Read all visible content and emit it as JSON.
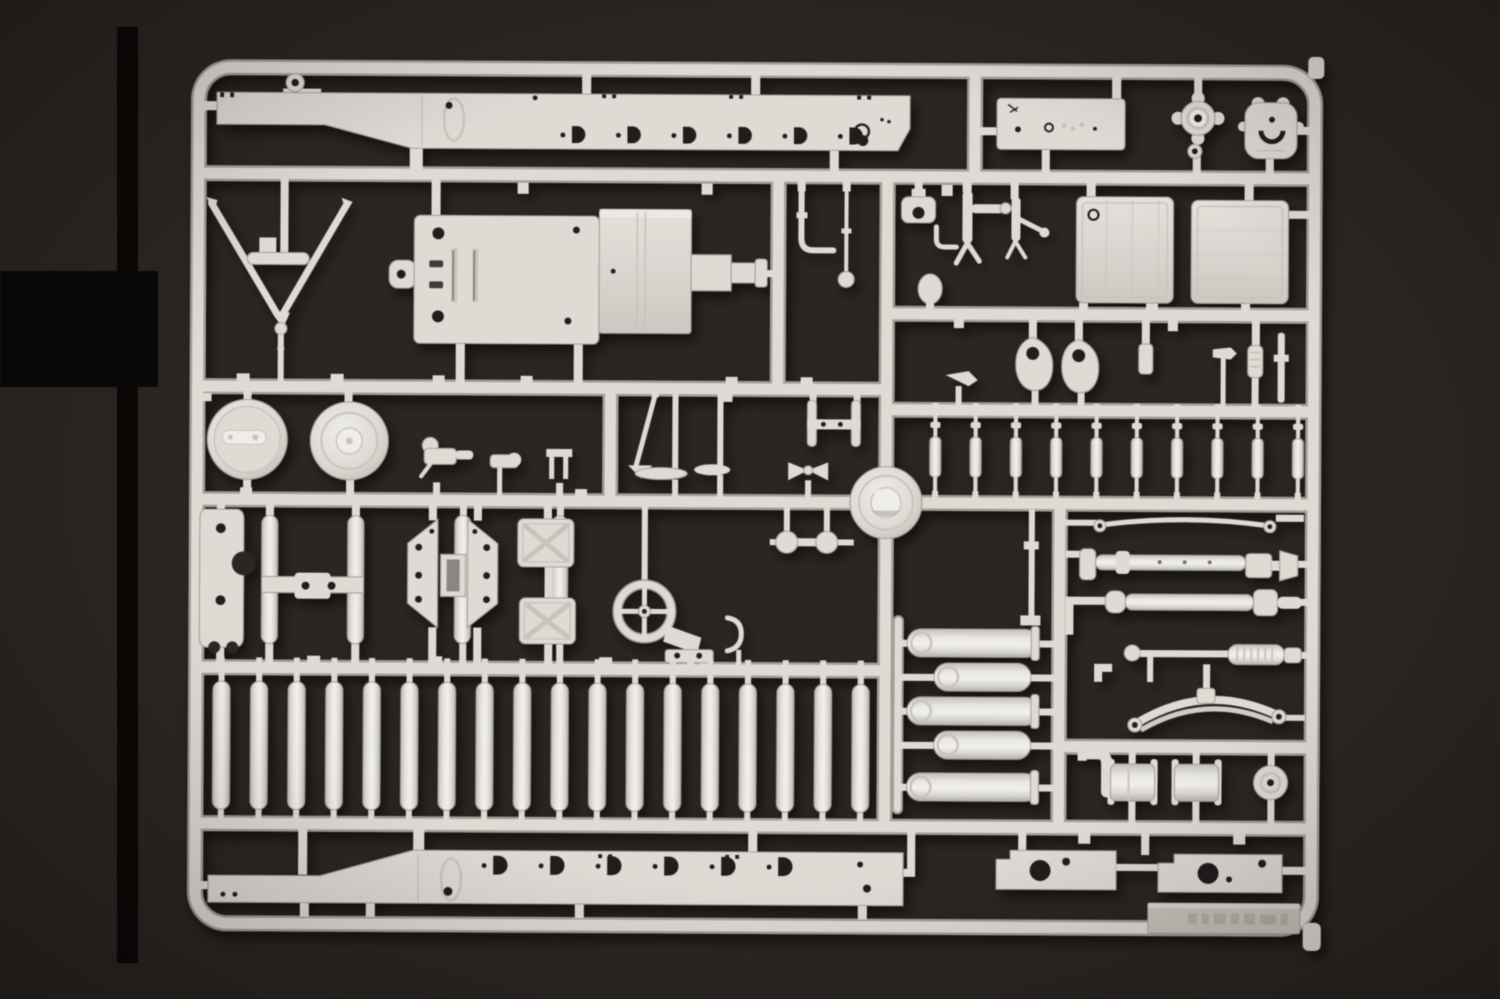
{
  "scene": {
    "type": "product photograph",
    "description": "Overhead product photo of an injection-moulded light grey polystyrene model-kit sprue (parts runner) for a military truck / artillery tractor kit, lying on a dark brown-black background. Black printing crop bars run along the left edge. The frame holds two long chassis side rails with stamped D-shaped slots, a V-shaped tow bar, an engine mounting plate with gearbox block, two round road wheels, rows of cylindrical rollers and bolts, two square fuel-tank panels, stacked exhaust cylinders, drive shafts, a curved leaf spring and many small fittings. An embossed maker tag in the lower right corner is not legible.",
    "background_color": "#2b2622",
    "crop_bar_color": "#0a0807",
    "plastic_color": "#dedbd5",
    "plastic_light_color": "#efede9",
    "plastic_dim_color": "#c8c4bd",
    "runner_edge_color": "#a39e97",
    "hole_color": "#241f1b"
  },
  "sprue": {
    "material": "light grey styrene",
    "maker_tag_text": "",
    "counts": {
      "road_rollers": 18,
      "track_bolts": 10,
      "top_rail_slots": 6,
      "bottom_rail_slots": 6,
      "muffler_cylinders": 5,
      "fuel_tanks": 2,
      "road_wheels": 2,
      "chassis_rails": 2,
      "square_cross_pads": 2,
      "teardrop_covers": 2,
      "bottom_plates": 2
    },
    "notable_parts": [
      {
        "id": "chassis-rail-top",
        "label": "Chassis side rail with D-slots (upper)"
      },
      {
        "id": "tow-bar",
        "label": "V-shaped tow bar with hitch ring"
      },
      {
        "id": "engine-plate",
        "label": "Engine mounting plate"
      },
      {
        "id": "gearbox-block",
        "label": "Gearbox block with muzzle shaft"
      },
      {
        "id": "road-wheel-strap",
        "label": "Road wheel with axle strap"
      },
      {
        "id": "road-wheel-ribbed",
        "label": "Road wheel with concentric ribs"
      },
      {
        "id": "fuel-tank-a",
        "label": "Square fuel tank panel with filler ring"
      },
      {
        "id": "fuel-tank-b",
        "label": "Square fuel tank panel, lined"
      },
      {
        "id": "central-hub",
        "label": "Central domed wheel hub"
      },
      {
        "id": "sight-wheel",
        "label": "Hand wheel with cross spokes"
      },
      {
        "id": "bogie-plates",
        "label": "Suspension bogie side plates"
      },
      {
        "id": "leaf-spring",
        "label": "Curved leaf spring with eyes"
      },
      {
        "id": "roller-row",
        "label": "Row of cylindrical road rollers"
      },
      {
        "id": "bolt-row",
        "label": "Row of suspension bolt pins"
      },
      {
        "id": "muffler-stack",
        "label": "Stack of exhaust / reservoir cylinders"
      },
      {
        "id": "drive-shafts",
        "label": "Drive shafts and torsion rods"
      },
      {
        "id": "chassis-rail-bottom",
        "label": "Chassis side rail with D-slots (lower)"
      },
      {
        "id": "maker-tag",
        "label": "Embossed maker tag (illegible)"
      }
    ]
  }
}
